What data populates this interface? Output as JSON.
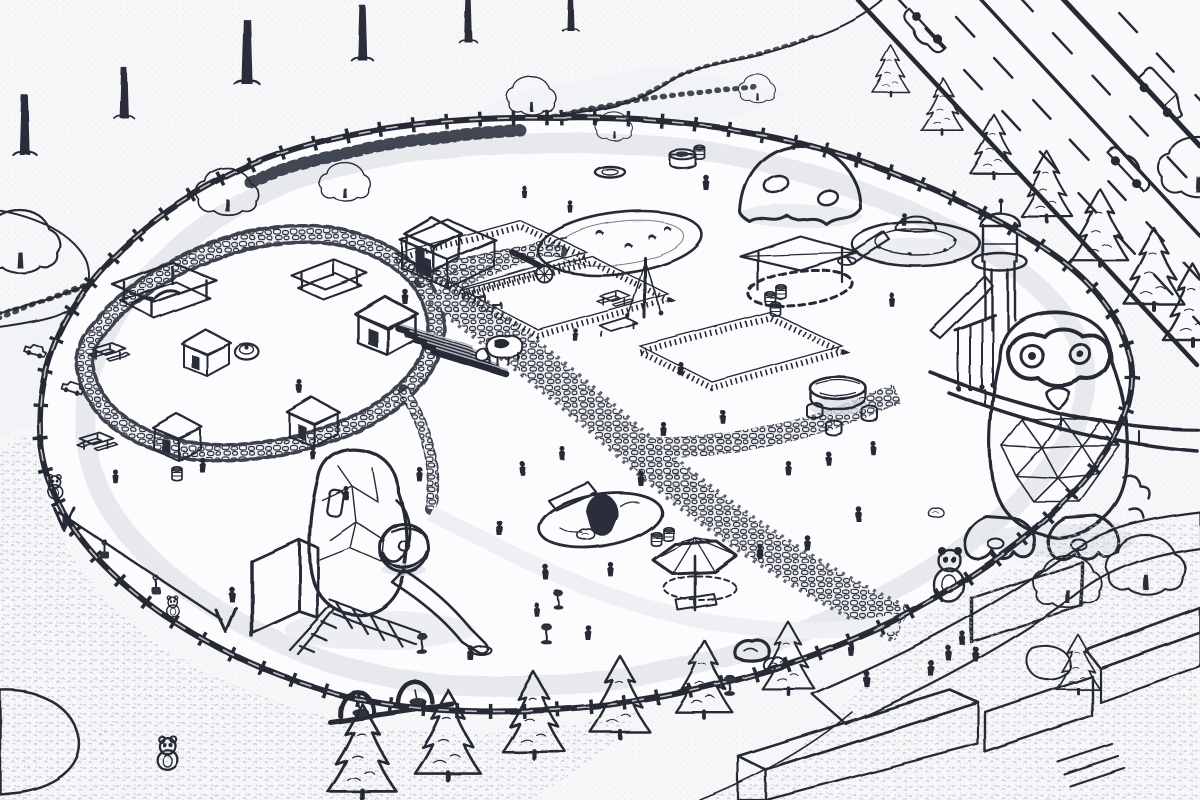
{
  "meta": {
    "scene_type": "isometric park map illustration",
    "art_style": "monochrome pencil-sketch line art",
    "visible_text": []
  },
  "palette": {
    "ink": "#262a35",
    "paper": "#f7f7f9",
    "ground_light": "#fbfbfd",
    "shade_light": "#eef0f3",
    "shade_mid": "#d8dbe1",
    "foliage_gray": "#d2d6dd",
    "dark_mesh": "#30343f"
  },
  "objects": [
    {
      "name": "tree-canopy-band",
      "desc": "dense deciduous tree row along upper-left walkway"
    },
    {
      "name": "highway",
      "desc": "diagonal multi-lane road with dashed lane markings and vehicles"
    },
    {
      "name": "park-log-fence",
      "desc": "rustic log fence enclosing the oval park"
    },
    {
      "name": "perimeter-path",
      "desc": "light walking loop inside the fence"
    },
    {
      "name": "pond-with-ducks",
      "desc": "small pond with ducks, upper-center"
    },
    {
      "name": "net-climbing-dome",
      "desc": "dark rope-mesh dome with crawl holes"
    },
    {
      "name": "saucer-slide-mound",
      "desc": "UFO-shaped mound with slide"
    },
    {
      "name": "lookout-tower",
      "desc": "round tower with dome roof, deck and hanging bars"
    },
    {
      "name": "owl-play-structure",
      "desc": "giant owl with goggle eyes, geodesic belly, splayed feet"
    },
    {
      "name": "penguin-play-structure",
      "desc": "faceted penguin climber with striped ball, slide and lattice screens"
    },
    {
      "name": "tunnel-mound",
      "desc": "small hill with tunnel hole and climbing board"
    },
    {
      "name": "petting-zoo",
      "desc": "barn, animal pens, stable rows, cow and goats"
    },
    {
      "name": "playhouse-village",
      "desc": "cluster of small huts, pavilion and picnic tables"
    },
    {
      "name": "shade-umbrella",
      "desc": "large pentagonal canopy over sand table"
    },
    {
      "name": "shade-sail-sandpit",
      "desc": "sand pit with triangular shade sail"
    },
    {
      "name": "round-table-with-stools",
      "desc": "round wooden table and stools"
    },
    {
      "name": "swing-frames",
      "desc": "arched basket swings on platform"
    },
    {
      "name": "zip-line",
      "desc": "cable ride with hanging gondola seats"
    },
    {
      "name": "spring-riders",
      "desc": "small spring rocking toys"
    },
    {
      "name": "cobblestone-paths",
      "desc": "winding stone paths lined with bushes"
    },
    {
      "name": "entrance-building",
      "desc": "modern white walls, slat fences and curved plaza paths, bottom-right"
    },
    {
      "name": "mascot-statues",
      "desc": "small bear/panda figures"
    },
    {
      "name": "visitors",
      "desc": "many small human silhouettes"
    },
    {
      "name": "conifer-rows",
      "desc": "cone-shaped trees along road and bottom fence"
    }
  ],
  "placements": {
    "road_conifers": {
      "symbol": "sym-conifer",
      "name": "conifer-tree",
      "items": [
        [
          890,
          94,
          0.62
        ],
        [
          943,
          134,
          0.7
        ],
        [
          994,
          177,
          0.78
        ],
        [
          1047,
          220,
          0.86
        ],
        [
          1100,
          264,
          0.94
        ],
        [
          1154,
          308,
          1.0
        ],
        [
          1193,
          344,
          1.0
        ]
      ]
    },
    "bottom_conifers": {
      "symbol": "sym-conifer",
      "name": "conifer-tree",
      "items": [
        [
          362,
          796,
          1.15
        ],
        [
          448,
          778,
          1.1
        ],
        [
          534,
          756,
          1.05
        ],
        [
          620,
          736,
          1.0
        ],
        [
          704,
          716,
          0.95
        ],
        [
          788,
          692,
          0.88
        ],
        [
          1078,
          692,
          0.72
        ]
      ]
    },
    "street_tree_trunks": {
      "symbol": "sym-trunk",
      "name": "street-tree-trunk",
      "items": [
        [
          25,
          155,
          1.3
        ],
        [
          124,
          118,
          1.1
        ],
        [
          247,
          84,
          1.4
        ],
        [
          362,
          60,
          1.2
        ],
        [
          468,
          42,
          1.0
        ],
        [
          570,
          30,
          0.9
        ]
      ]
    },
    "round_trees": {
      "symbol": "sym-tree-round",
      "name": "deciduous-tree",
      "items": [
        [
          228,
          212,
          0.75
        ],
        [
          20,
          268,
          1.0
        ],
        [
          345,
          198,
          0.62
        ],
        [
          532,
          112,
          0.6
        ],
        [
          614,
          138,
          0.45
        ],
        [
          757,
          100,
          0.45
        ],
        [
          1198,
          192,
          0.95
        ],
        [
          1068,
          604,
          0.85
        ],
        [
          1146,
          590,
          0.95
        ]
      ]
    },
    "cars": {
      "symbol": "sym-sedan",
      "name": "car",
      "items": [
        [
          925,
          30,
          1,
          227
        ],
        [
          1128,
          170,
          1,
          47
        ]
      ]
    },
    "vans": {
      "symbol": "sym-van",
      "name": "delivery-van",
      "items": [
        [
          1158,
          98,
          1,
          47
        ]
      ]
    },
    "toy_vehicles": {
      "symbol": "sym-toycar",
      "name": "ride-on-toy-car",
      "items": [
        [
          34,
          354,
          1,
          18
        ],
        [
          72,
          392,
          1,
          18
        ]
      ]
    },
    "ducks": {
      "symbol": "sym-duck",
      "name": "duck",
      "items": [
        [
          600,
          236,
          1
        ],
        [
          628,
          248,
          1
        ],
        [
          652,
          240,
          1
        ],
        [
          668,
          232,
          0.9
        ]
      ]
    },
    "barrels": {
      "symbol": "sym-barrel",
      "name": "barrel",
      "items": [
        [
          770,
          306,
          1
        ],
        [
          781,
          299,
          1
        ],
        [
          775,
          316,
          1
        ],
        [
          656,
          546,
          1
        ],
        [
          668,
          541,
          1
        ],
        [
          176,
          480,
          1
        ],
        [
          700,
          160,
          1
        ]
      ]
    },
    "rocks": {
      "symbol": "sym-rock",
      "name": "rock",
      "items": [
        [
          752,
          654,
          1.6
        ],
        [
          774,
          666,
          1.0
        ],
        [
          586,
          536,
          0.8
        ],
        [
          936,
          514,
          0.7
        ]
      ]
    },
    "picnic_tables": {
      "symbol": "sym-picnic",
      "name": "picnic-table",
      "items": [
        [
          108,
          358,
          1
        ],
        [
          96,
          448,
          1
        ],
        [
          614,
          304,
          0.9
        ]
      ]
    },
    "playhouses": {
      "symbol": "sym-hut",
      "name": "playhouse-hut",
      "items": [
        [
          205,
          364,
          1,
          0
        ],
        [
          176,
          448,
          1,
          0
        ],
        [
          312,
          434,
          1.05,
          0
        ],
        [
          432,
          258,
          1.15,
          0
        ],
        [
          385,
          340,
          1.25,
          0
        ]
      ]
    },
    "spring_riders": {
      "symbol": "sym-rider",
      "name": "spring-rider",
      "items": [
        [
          422,
          652,
          1
        ],
        [
          546,
          642,
          1
        ],
        [
          558,
          607,
          0.9
        ],
        [
          730,
          694,
          1
        ]
      ]
    },
    "bear_statues": {
      "symbol": "sym-bear",
      "name": "bear-statue",
      "items": [
        [
          55,
          494,
          0.8
        ],
        [
          168,
          764,
          1.15
        ],
        [
          172,
          612,
          0.7
        ]
      ]
    },
    "zipline_gondolas": {
      "symbol": "sym-gondola",
      "name": "zipline-gondola",
      "items": [
        [
          105,
          545,
          1
        ],
        [
          156,
          580,
          1
        ]
      ]
    },
    "visitors": {
      "symbol": "sym-person",
      "name": "visitor",
      "items": [
        [
          405,
          302,
          1
        ],
        [
          300,
          392,
          0.9
        ],
        [
          202,
          470,
          1
        ],
        [
          232,
          600,
          1
        ],
        [
          313,
          458,
          0.9
        ],
        [
          346,
          498,
          0.9
        ],
        [
          470,
          658,
          1
        ],
        [
          500,
          534,
          1
        ],
        [
          523,
          474,
          0.9
        ],
        [
          546,
          578,
          1
        ],
        [
          562,
          458,
          0.9
        ],
        [
          588,
          638,
          1
        ],
        [
          610,
          574,
          0.95
        ],
        [
          641,
          484,
          1
        ],
        [
          663,
          434,
          0.95
        ],
        [
          681,
          374,
          0.9
        ],
        [
          706,
          188,
          1
        ],
        [
          723,
          422,
          0.9
        ],
        [
          761,
          558,
          1
        ],
        [
          789,
          474,
          0.95
        ],
        [
          807,
          548,
          1
        ],
        [
          829,
          464,
          0.9
        ],
        [
          859,
          520,
          1
        ],
        [
          874,
          454,
          0.9
        ],
        [
          891,
          304,
          0.9
        ],
        [
          904,
          224,
          0.85
        ],
        [
          931,
          674,
          1.05
        ],
        [
          949,
          659,
          1
        ],
        [
          963,
          644,
          0.95
        ],
        [
          976,
          660,
          1
        ],
        [
          866,
          684,
          1.05
        ],
        [
          851,
          654,
          0.95
        ],
        [
          116,
          482,
          0.9
        ],
        [
          420,
          480,
          0.95
        ],
        [
          576,
          340,
          0.85
        ],
        [
          536,
          614,
          0.9
        ],
        [
          571,
          212,
          0.8
        ],
        [
          524,
          196,
          0.8
        ]
      ]
    }
  }
}
